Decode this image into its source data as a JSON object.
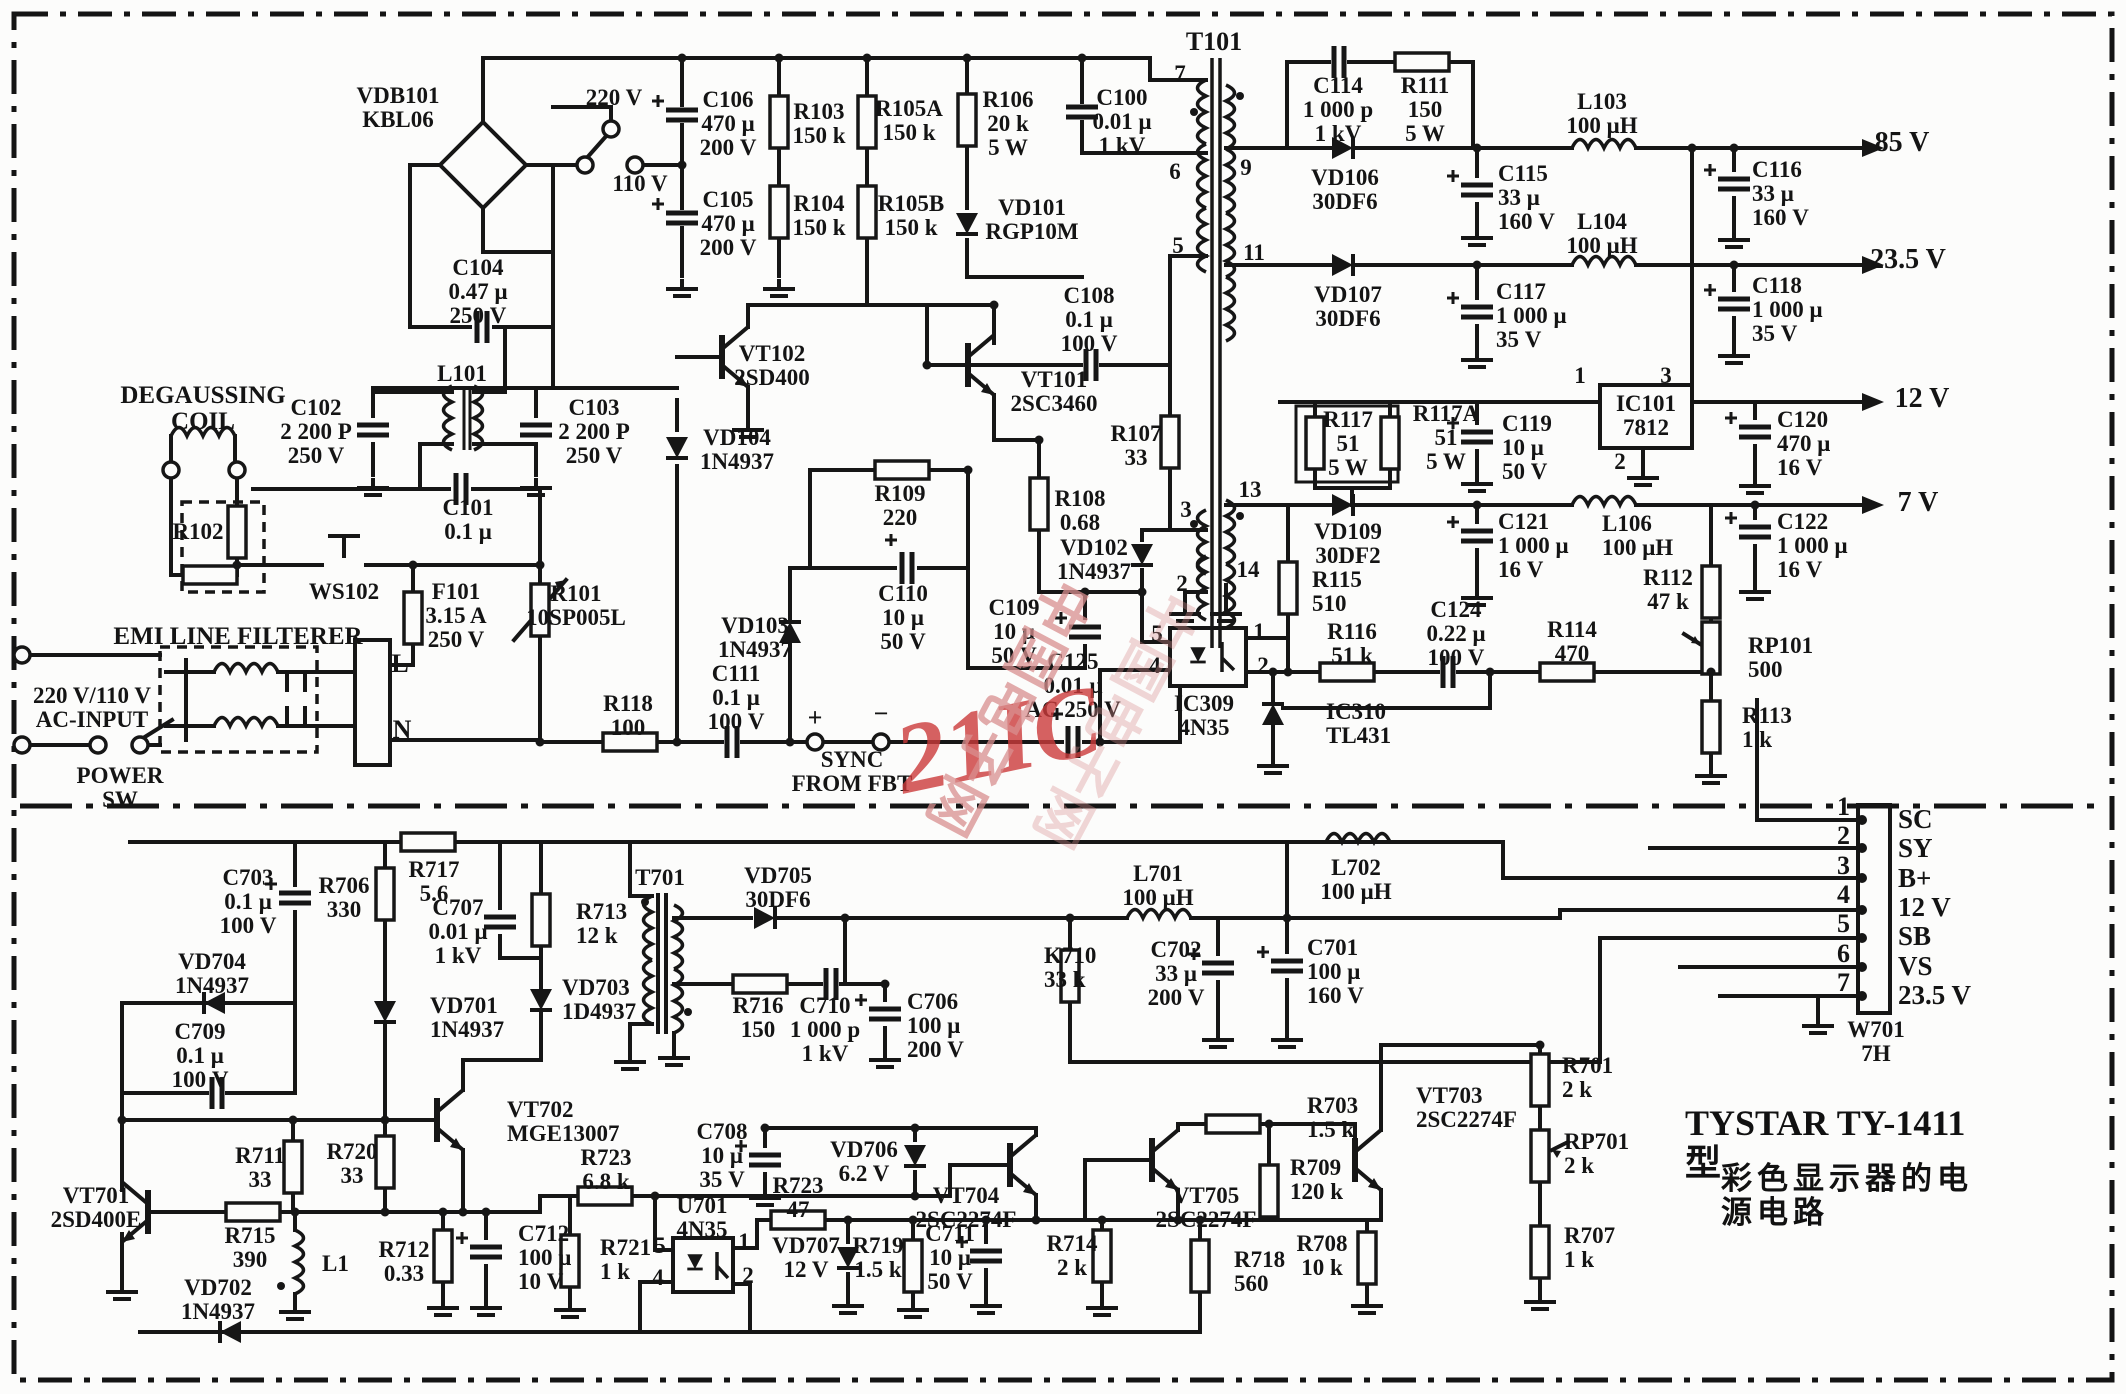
{
  "title": {
    "model": "TYSTAR TY-1411 型",
    "caption": "彩色显示器的电源电路"
  },
  "watermark": {
    "brand": "21IC",
    "site": "中国电子网",
    "brand_color": "#cc3b3b"
  },
  "outputs": {
    "rail_85v": "85 V",
    "rail_23_5v": "23.5 V",
    "rail_12v": "12 V",
    "rail_7v": "7 V"
  },
  "connector": {
    "designator": "W701",
    "type": "7H",
    "pins": [
      {
        "n": "1",
        "label": "SC"
      },
      {
        "n": "2",
        "label": "SY"
      },
      {
        "n": "3",
        "label": "B+"
      },
      {
        "n": "4",
        "label": "12 V"
      },
      {
        "n": "5",
        "label": "SB"
      },
      {
        "n": "6",
        "label": "VS"
      },
      {
        "n": "7",
        "label": "23.5 V"
      }
    ]
  },
  "labels": [
    {
      "t": "VDB101\nKBL06",
      "x": 398,
      "y": 84
    },
    {
      "t": "220 V",
      "x": 614,
      "y": 86
    },
    {
      "t": "110 V",
      "x": 640,
      "y": 172
    },
    {
      "t": "C106\n470 μ\n200 V",
      "x": 728,
      "y": 88
    },
    {
      "t": "R103\n150 k",
      "x": 819,
      "y": 100
    },
    {
      "t": "R105A\n150 k",
      "x": 909,
      "y": 97
    },
    {
      "t": "R106\n20 k\n5 W",
      "x": 1008,
      "y": 88
    },
    {
      "t": "C100\n0.01 μ\n1 kV",
      "x": 1122,
      "y": 86
    },
    {
      "t": "C105\n470 μ\n200 V",
      "x": 728,
      "y": 188
    },
    {
      "t": "R104\n150 k",
      "x": 819,
      "y": 192
    },
    {
      "t": "R105B\n150 k",
      "x": 911,
      "y": 192
    },
    {
      "t": "VD101\nRGP10M",
      "x": 1032,
      "y": 196
    },
    {
      "t": "T101",
      "x": 1214,
      "y": 28,
      "fs": 26
    },
    {
      "t": "7",
      "x": 1180,
      "y": 62
    },
    {
      "t": "6",
      "x": 1175,
      "y": 160
    },
    {
      "t": "5",
      "x": 1178,
      "y": 234
    },
    {
      "t": "9",
      "x": 1246,
      "y": 156
    },
    {
      "t": "11",
      "x": 1254,
      "y": 241
    },
    {
      "t": "13",
      "x": 1250,
      "y": 478
    },
    {
      "t": "14",
      "x": 1248,
      "y": 558
    },
    {
      "t": "3",
      "x": 1186,
      "y": 498
    },
    {
      "t": "2",
      "x": 1182,
      "y": 572
    },
    {
      "t": "C114\n1 000 p\n1 kV",
      "x": 1338,
      "y": 74
    },
    {
      "t": "R111\n150\n5 W",
      "x": 1425,
      "y": 74
    },
    {
      "t": "VD106\n30DF6",
      "x": 1345,
      "y": 166
    },
    {
      "t": "C115\n33 μ\n160 V",
      "x": 1498,
      "y": 162,
      "al": "l"
    },
    {
      "t": "L103\n100 μH",
      "x": 1602,
      "y": 90
    },
    {
      "t": "85 V",
      "x": 1902,
      "y": 128,
      "fs": 28
    },
    {
      "t": "C116\n33 μ\n160 V",
      "x": 1752,
      "y": 158,
      "al": "l"
    },
    {
      "t": "VD107\n30DF6",
      "x": 1348,
      "y": 283
    },
    {
      "t": "C117\n1 000 μ\n35 V",
      "x": 1496,
      "y": 280,
      "al": "l"
    },
    {
      "t": "L104\n100 μH",
      "x": 1602,
      "y": 210
    },
    {
      "t": "23.5 V",
      "x": 1908,
      "y": 245,
      "fs": 28
    },
    {
      "t": "C118\n1 000 μ\n35 V",
      "x": 1752,
      "y": 274,
      "al": "l"
    },
    {
      "t": "C104\n0.47 μ\n250 V",
      "x": 478,
      "y": 256
    },
    {
      "t": "L101",
      "x": 462,
      "y": 362
    },
    {
      "t": "DEGAUSSING\nCOIL",
      "x": 203,
      "y": 383,
      "fs": 25
    },
    {
      "t": "C102\n2 200 P\n250 V",
      "x": 316,
      "y": 396
    },
    {
      "t": "C103\n2 200 P\n250 V",
      "x": 594,
      "y": 396
    },
    {
      "t": "C101\n0.1 μ",
      "x": 468,
      "y": 496
    },
    {
      "t": "R102",
      "x": 198,
      "y": 520
    },
    {
      "t": "WS102",
      "x": 344,
      "y": 580
    },
    {
      "t": "VT102\n2SD400",
      "x": 772,
      "y": 342
    },
    {
      "t": "VT101\n2SC3460",
      "x": 1054,
      "y": 368
    },
    {
      "t": "VD104\n1N4937",
      "x": 737,
      "y": 426
    },
    {
      "t": "C108\n0.1 μ\n100 V",
      "x": 1089,
      "y": 284
    },
    {
      "t": "R107\n33",
      "x": 1136,
      "y": 422
    },
    {
      "t": "R109\n220",
      "x": 900,
      "y": 482
    },
    {
      "t": "R108\n0.68",
      "x": 1080,
      "y": 487
    },
    {
      "t": "VD102\n1N4937",
      "x": 1094,
      "y": 536
    },
    {
      "t": "C110\n10 μ\n50 V",
      "x": 903,
      "y": 582
    },
    {
      "t": "VD103\n1N4937",
      "x": 755,
      "y": 614
    },
    {
      "t": "C109\n10 μ\n50 V",
      "x": 1014,
      "y": 596
    },
    {
      "t": "F101\n3.15 A\n250 V",
      "x": 456,
      "y": 580
    },
    {
      "t": "R101\n10SP005L",
      "x": 576,
      "y": 582
    },
    {
      "t": "EMI LINE FILTERER",
      "x": 238,
      "y": 624,
      "fs": 25
    },
    {
      "t": "220 V/110 V\nAC-INPUT",
      "x": 92,
      "y": 684
    },
    {
      "t": "POWER\nSW",
      "x": 120,
      "y": 764
    },
    {
      "t": "L",
      "x": 400,
      "y": 650,
      "fs": 26
    },
    {
      "t": "N",
      "x": 402,
      "y": 716,
      "fs": 26
    },
    {
      "t": "R118\n100",
      "x": 628,
      "y": 692
    },
    {
      "t": "C111\n0.1 μ\n100 V",
      "x": 736,
      "y": 662
    },
    {
      "t": "+",
      "x": 815,
      "y": 704,
      "fs": 26
    },
    {
      "t": "−",
      "x": 881,
      "y": 700,
      "fs": 26
    },
    {
      "t": "SYNC\nFROM  FBT",
      "x": 852,
      "y": 748
    },
    {
      "t": "C125\n0.01 μ\nAC 250 V",
      "x": 1073,
      "y": 650
    },
    {
      "t": "IC309\n4N35",
      "x": 1204,
      "y": 692
    },
    {
      "t": "5",
      "x": 1157,
      "y": 622
    },
    {
      "t": "4",
      "x": 1155,
      "y": 654
    },
    {
      "t": "1",
      "x": 1259,
      "y": 620
    },
    {
      "t": "2",
      "x": 1263,
      "y": 654
    },
    {
      "t": "IC310\nTL431",
      "x": 1326,
      "y": 700,
      "al": "l"
    },
    {
      "t": "R115\n510",
      "x": 1312,
      "y": 568,
      "al": "l"
    },
    {
      "t": "R117\n51\n5 W",
      "x": 1348,
      "y": 408
    },
    {
      "t": "R117A\n51\n5 W",
      "x": 1446,
      "y": 402
    },
    {
      "t": "C119\n10 μ\n50 V",
      "x": 1502,
      "y": 412,
      "al": "l"
    },
    {
      "t": "IC101\n7812",
      "x": 1646,
      "y": 392
    },
    {
      "t": "1",
      "x": 1580,
      "y": 364
    },
    {
      "t": "3",
      "x": 1666,
      "y": 364
    },
    {
      "t": "2",
      "x": 1620,
      "y": 450
    },
    {
      "t": "VD109\n30DF2",
      "x": 1348,
      "y": 520
    },
    {
      "t": "C121\n1 000 μ\n16 V",
      "x": 1498,
      "y": 510,
      "al": "l"
    },
    {
      "t": "L106\n100 μH",
      "x": 1602,
      "y": 512,
      "al": "l"
    },
    {
      "t": "12 V",
      "x": 1922,
      "y": 384,
      "fs": 28
    },
    {
      "t": "C120\n470 μ\n16 V",
      "x": 1777,
      "y": 408,
      "al": "l"
    },
    {
      "t": "7 V",
      "x": 1918,
      "y": 488,
      "fs": 28
    },
    {
      "t": "C122\n1 000 μ\n16 V",
      "x": 1777,
      "y": 510,
      "al": "l"
    },
    {
      "t": "R112\n47 k",
      "x": 1668,
      "y": 566
    },
    {
      "t": "R116\n51 k",
      "x": 1352,
      "y": 620
    },
    {
      "t": "C124\n0.22 μ\n100 V",
      "x": 1456,
      "y": 598
    },
    {
      "t": "R114\n470",
      "x": 1572,
      "y": 618
    },
    {
      "t": "RP101\n500",
      "x": 1748,
      "y": 634,
      "al": "l"
    },
    {
      "t": "R113\n1 k",
      "x": 1742,
      "y": 704,
      "al": "l"
    },
    {
      "t": "W701\n7H",
      "x": 1876,
      "y": 1018
    },
    {
      "t": "C703\n0.1 μ\n100 V",
      "x": 248,
      "y": 866
    },
    {
      "t": "R706\n330",
      "x": 344,
      "y": 874
    },
    {
      "t": "R717\n5.6",
      "x": 434,
      "y": 858
    },
    {
      "t": "C707\n0.01 μ\n1 kV",
      "x": 458,
      "y": 896
    },
    {
      "t": "R713\n12 k",
      "x": 576,
      "y": 900,
      "al": "l"
    },
    {
      "t": "T701",
      "x": 660,
      "y": 866
    },
    {
      "t": "VD705\n30DF6",
      "x": 778,
      "y": 864
    },
    {
      "t": "R716\n150",
      "x": 758,
      "y": 994
    },
    {
      "t": "VD704\n1N4937",
      "x": 212,
      "y": 950
    },
    {
      "t": "VD701\n1N4937",
      "x": 430,
      "y": 994,
      "al": "l"
    },
    {
      "t": "VD703\n1D4937",
      "x": 562,
      "y": 976,
      "al": "l"
    },
    {
      "t": "C709\n0.1 μ\n100 V",
      "x": 200,
      "y": 1020
    },
    {
      "t": "C710\n1 000 p\n1 kV",
      "x": 825,
      "y": 994
    },
    {
      "t": "C706\n100 μ\n200 V",
      "x": 907,
      "y": 990,
      "al": "l"
    },
    {
      "t": "L701\n100 μH",
      "x": 1158,
      "y": 862
    },
    {
      "t": "L702\n100 μH",
      "x": 1356,
      "y": 856
    },
    {
      "t": "K710\n33 k",
      "x": 1044,
      "y": 944,
      "al": "l"
    },
    {
      "t": "C702\n33 μ\n200 V",
      "x": 1176,
      "y": 938
    },
    {
      "t": "C701\n100 μ\n160 V",
      "x": 1307,
      "y": 936,
      "al": "l"
    },
    {
      "t": "VT702\nMGE13007",
      "x": 507,
      "y": 1098,
      "al": "l"
    },
    {
      "t": "R711\n33",
      "x": 260,
      "y": 1144
    },
    {
      "t": "R720\n33",
      "x": 352,
      "y": 1140
    },
    {
      "t": "R723\n6.8 k",
      "x": 606,
      "y": 1146
    },
    {
      "t": "C708\n10 μ\n35 V",
      "x": 722,
      "y": 1120
    },
    {
      "t": "VD706\n6.2 V",
      "x": 864,
      "y": 1138
    },
    {
      "t": "VT704\n2SC2274F",
      "x": 966,
      "y": 1184
    },
    {
      "t": "VT705\n2SC2274F",
      "x": 1206,
      "y": 1184
    },
    {
      "t": "R703\n1.5 k",
      "x": 1307,
      "y": 1094,
      "al": "l"
    },
    {
      "t": "VT703\n2SC2274F",
      "x": 1416,
      "y": 1084,
      "al": "l"
    },
    {
      "t": "R709\n120 k",
      "x": 1290,
      "y": 1156,
      "al": "l"
    },
    {
      "t": "R701\n2 k",
      "x": 1562,
      "y": 1054,
      "al": "l"
    },
    {
      "t": "RP701\n2 k",
      "x": 1564,
      "y": 1130,
      "al": "l"
    },
    {
      "t": "R707\n1 k",
      "x": 1564,
      "y": 1224,
      "al": "l"
    },
    {
      "t": "VT701\n2SD400E",
      "x": 96,
      "y": 1184
    },
    {
      "t": "R715\n390",
      "x": 250,
      "y": 1224
    },
    {
      "t": "L1",
      "x": 322,
      "y": 1252,
      "al": "l"
    },
    {
      "t": "R712\n0.33",
      "x": 404,
      "y": 1238
    },
    {
      "t": "C712\n100 μ\n10 V",
      "x": 518,
      "y": 1222,
      "al": "l"
    },
    {
      "t": "R721\n1 k",
      "x": 600,
      "y": 1236,
      "al": "l"
    },
    {
      "t": "U701\n4N35",
      "x": 702,
      "y": 1194
    },
    {
      "t": "5",
      "x": 660,
      "y": 1234
    },
    {
      "t": "4",
      "x": 658,
      "y": 1266
    },
    {
      "t": "1",
      "x": 744,
      "y": 1230
    },
    {
      "t": "2",
      "x": 748,
      "y": 1264
    },
    {
      "t": "R723\n47",
      "x": 798,
      "y": 1174
    },
    {
      "t": "VD707\n12 V",
      "x": 806,
      "y": 1234
    },
    {
      "t": "R719\n1.5 k",
      "x": 878,
      "y": 1234
    },
    {
      "t": "C711\n10 μ\n50 V",
      "x": 950,
      "y": 1222
    },
    {
      "t": "R714\n2 k",
      "x": 1072,
      "y": 1232
    },
    {
      "t": "R718\n560",
      "x": 1234,
      "y": 1248,
      "al": "l"
    },
    {
      "t": "R708\n10 k",
      "x": 1322,
      "y": 1232
    },
    {
      "t": "VD702\n1N4937",
      "x": 218,
      "y": 1276
    }
  ]
}
